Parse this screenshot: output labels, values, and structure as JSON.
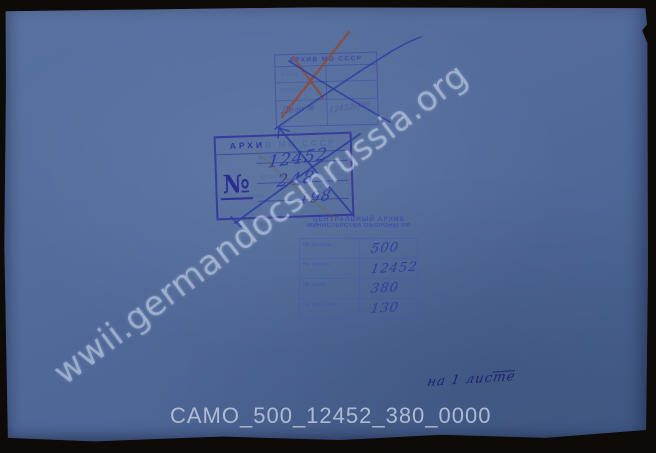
{
  "scan": {
    "watermark": "wwii.germandocsinrussia.org",
    "caption": "CAMO_500_12452_380_0000",
    "sheet_note": "на 1 листе"
  },
  "stamp_old_small": {
    "header": "АРХИВ МО СССР",
    "row1_label": "ФОНД",
    "row2_label": "ОПИСЬ",
    "row3_label": "Дело №",
    "row3_value": "12452/380"
  },
  "stamp_old_large": {
    "header_visible": "АРХИ",
    "header_faded": "В МО СССР",
    "number_sign": "№",
    "row1_label": "ФОНД",
    "row2_label": "ОПИСЬ",
    "row3_label": "ДЕЛО",
    "row1_value": "12452",
    "row2_value": "248",
    "row3_value": "198"
  },
  "stamp_camo": {
    "header_line1": "ЦЕНТРАЛЬНЫЙ АРХИВ",
    "header_line2": "МИНИСТЕРСТВА ОБОРОНЫ РФ",
    "rows": [
      {
        "label": "№ фонда",
        "value": "500"
      },
      {
        "label": "№ описи",
        "value": "12452"
      },
      {
        "label": "№ дела",
        "value": "380"
      },
      {
        "label": "№ фильма",
        "value": "130"
      }
    ]
  },
  "colors": {
    "background": "#0d0a08",
    "paper_blue": "#50689a",
    "stamp_violet": "#34349b",
    "pen_blue": "#2c3aa5",
    "cross_red": "#8e4a38",
    "watermark": "#dce6f4",
    "caption": "#b6c2d8"
  }
}
